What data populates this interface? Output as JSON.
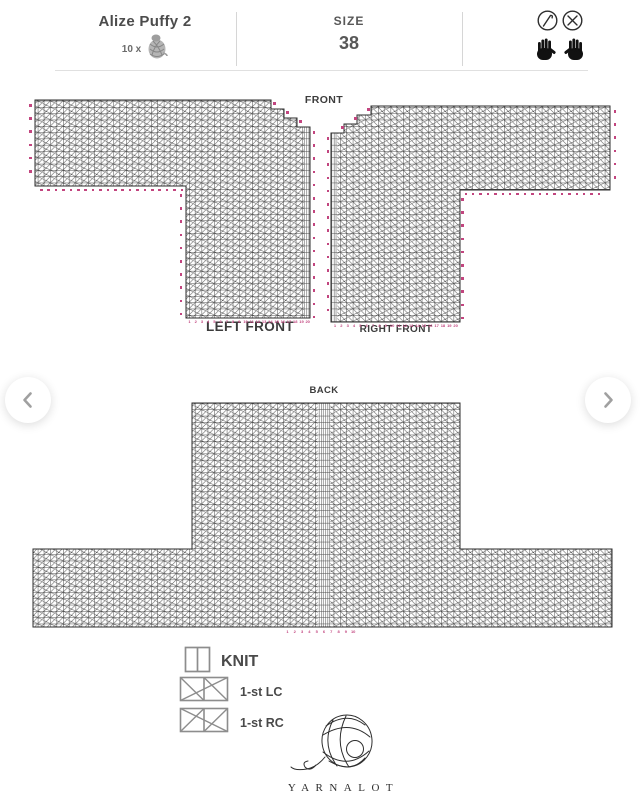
{
  "header": {
    "yarn_name": "Alize Puffy 2",
    "yarn_quantity_label": "10 x",
    "size_label": "SIZE",
    "size_value": "38"
  },
  "charts": {
    "front_title": "FRONT",
    "left_front_label": "LEFT FRONT",
    "right_front_label": "RIGHT FRONT",
    "back_title": "BACK",
    "front_bottom_numbers": [
      1,
      2,
      3,
      4,
      5,
      6,
      7,
      8,
      9,
      10,
      11,
      12,
      13,
      14,
      15,
      16,
      17,
      18,
      19,
      20
    ],
    "back_bottom_numbers": [
      1,
      2,
      3,
      4,
      5,
      6,
      7,
      8,
      9,
      10
    ],
    "marker_color": "#c2457f"
  },
  "legend": {
    "items": [
      {
        "symbol": "knit-cell",
        "label": "KNIT"
      },
      {
        "symbol": "left-cross-2cell",
        "label": "1-st LC"
      },
      {
        "symbol": "right-cross-2cell",
        "label": "1-st RC"
      }
    ]
  },
  "footer": {
    "brand": "YARNALOT"
  }
}
